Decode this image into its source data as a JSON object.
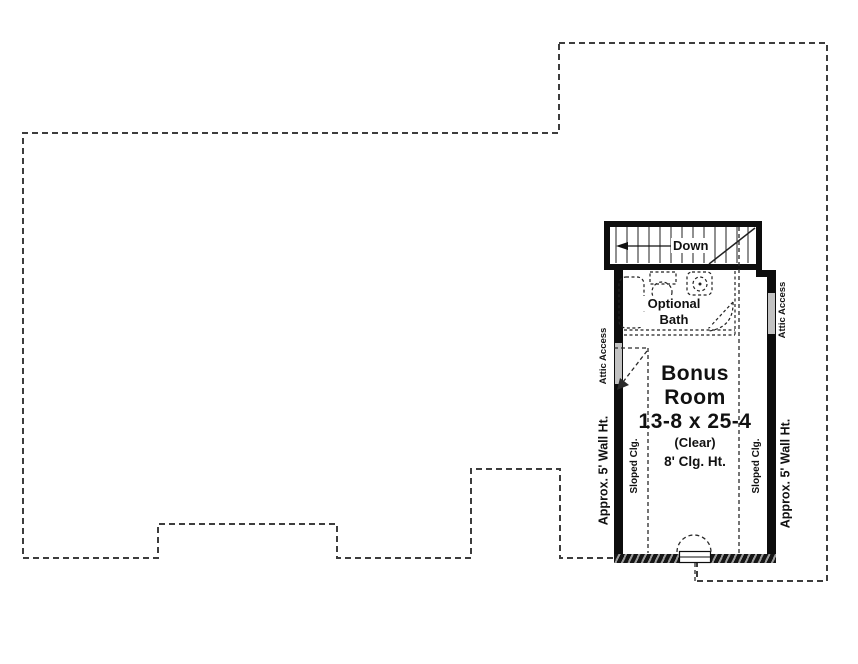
{
  "plan": {
    "title_room": {
      "line1": "Bonus",
      "line2": "Room",
      "dimensions": "13-8 x 25-4",
      "clear_note": "(Clear)",
      "ceiling_note": "8' Clg. Ht."
    },
    "stairs": {
      "label": "Down"
    },
    "optional_bath": {
      "line1": "Optional",
      "line2": "Bath"
    },
    "attic_access_left": "Attic Access",
    "attic_access_right": "Attic Access",
    "sloped_ceiling_left": "Sloped Clg.",
    "sloped_ceiling_right": "Sloped Clg.",
    "wall_height_left": "Approx. 5' Wall Ht.",
    "wall_height_right": "Approx. 5' Wall Ht."
  },
  "colors": {
    "background": "#ffffff",
    "wall": "#0d0d0d",
    "roof_outline_dash": "#3d3d3d",
    "interior_dash": "#2a2a2a",
    "attic_opening": "#c2c2c2",
    "text": "#111111"
  }
}
